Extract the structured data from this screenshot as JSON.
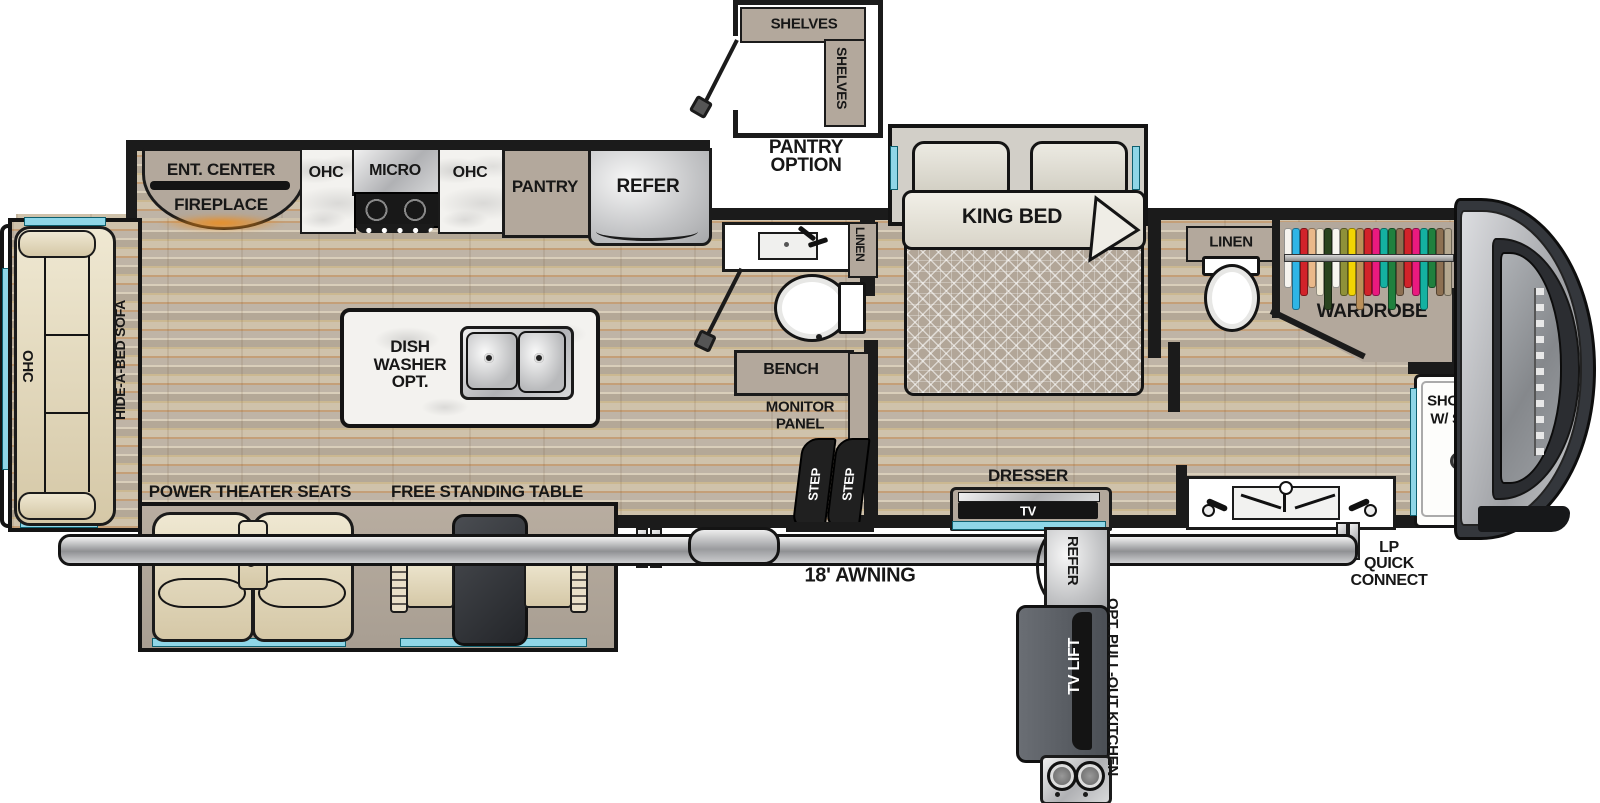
{
  "colors": {
    "wall": "#1b1b1b",
    "window_cyan": "#8fd6e7",
    "cabinet_tan": "#b3a89c",
    "floor_wood": "#c5b69e",
    "marble": "#f3f2ef",
    "seat_cream": "#e8dfc6",
    "steel": "#c9cacc",
    "step_dark": "#202020",
    "tv_lift_gray": "#565a60",
    "fireplace_glow": "#f08a14"
  },
  "pantry_inset": {
    "shelf_top": "SHELVES",
    "shelf_side": "SHELVES",
    "caption_1": "PANTRY",
    "caption_2": "OPTION"
  },
  "galley": {
    "ent_center": "ENT. CENTER",
    "fireplace": "FIREPLACE",
    "ohc_1": "OHC",
    "micro": "MICRO",
    "ohc_2": "OHC",
    "pantry": "PANTRY",
    "refer": "REFER"
  },
  "island": {
    "line_1": "DISH",
    "line_2": "WASHER",
    "line_3": "OPT."
  },
  "living": {
    "ohc": "OHC",
    "sofa": "HIDE-A-BED SOFA",
    "theater_seats": "POWER THEATER SEATS",
    "table": "FREE STANDING TABLE"
  },
  "mid_bath": {
    "linen": "LINEN",
    "bench": "BENCH",
    "monitor_1": "MONITOR",
    "monitor_2": "PANEL",
    "step_1": "STEP",
    "step_2": "STEP"
  },
  "bedroom": {
    "king_bed": "KING BED",
    "dresser": "DRESSER",
    "tv": "TV"
  },
  "front_bath": {
    "linen": "LINEN",
    "wardrobe": "WARDROBE",
    "wd_prep_1": "W/D",
    "wd_prep_2": "PREP",
    "shower_1": "SHOWER",
    "shower_2": "W/ SEAT",
    "clothes_colors": [
      "#f5f3ee",
      "#2fb5e6",
      "#d2232a",
      "#eab98a",
      "#f1e9d4",
      "#2a431f",
      "#f7f5f0",
      "#8f9139",
      "#f2d403",
      "#bb9059",
      "#d2232a",
      "#ea1a7f",
      "#14b1a1",
      "#20803e",
      "#8d7052",
      "#d2232a",
      "#ea1a7f",
      "#14b1a1",
      "#20803e",
      "#8d7052",
      "#b5a890"
    ]
  },
  "exterior": {
    "awning": "18' AWNING",
    "lp_1": "LP",
    "lp_2": "QUICK",
    "lp_3": "CONNECT",
    "refer": "REFER",
    "tv_lift": "TV LIFT",
    "pull_out_kitchen": "OPT. PULL-OUT KITCHEN"
  }
}
